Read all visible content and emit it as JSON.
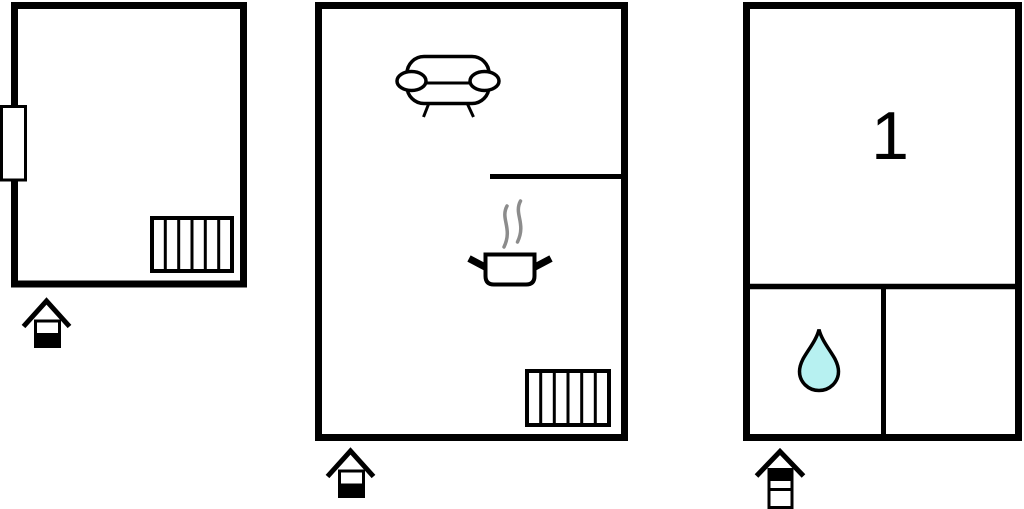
{
  "canvas": {
    "width": 1024,
    "height": 509,
    "background": "#ffffff"
  },
  "colors": {
    "wall": "#000000",
    "steam": "#8c8c8c",
    "water_drop_fill": "#b7f1f1",
    "background": "#ffffff"
  },
  "labels": {
    "room_number": "1"
  },
  "floorplans": [
    {
      "id": "left",
      "name": "floorplan-left",
      "features": [
        "window",
        "radiator"
      ],
      "entrance": {
        "icon": "house-level-icon",
        "floors": 2,
        "highlighted_floor": "lower"
      }
    },
    {
      "id": "middle",
      "name": "floorplan-middle",
      "features": [
        "sofa",
        "interior-wall",
        "cooking-pot-with-steam",
        "radiator"
      ],
      "entrance": {
        "icon": "house-level-icon",
        "floors": 2,
        "highlighted_floor": "lower"
      }
    },
    {
      "id": "right",
      "name": "floorplan-right",
      "room_label": "1",
      "features": [
        "water-drop",
        "interior-wall-horizontal",
        "interior-wall-vertical"
      ],
      "entrance": {
        "icon": "house-level-icon",
        "floors": 3,
        "highlighted_floor": "upper"
      }
    }
  ]
}
